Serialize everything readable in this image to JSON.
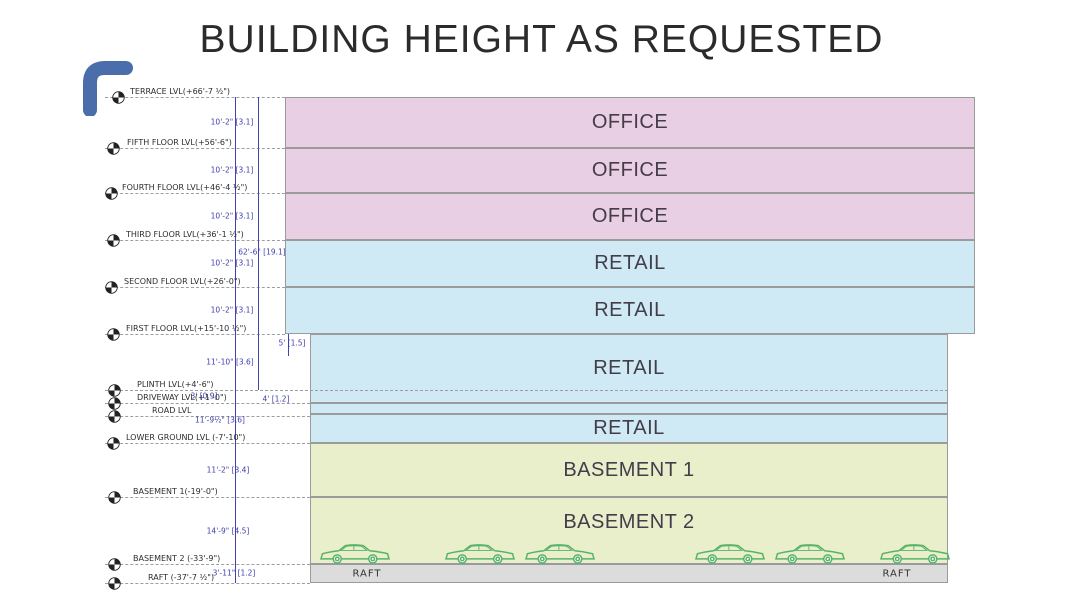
{
  "title": "BUILDING HEIGHT AS REQUESTED",
  "colors": {
    "office": "#e9cfe3",
    "retail": "#cfeaf4",
    "basement": "#e8efca",
    "raft": "#dcdcdc",
    "band_border": "#9b9b9b",
    "dimension_blue": "#4343ae",
    "corner_accent": "#4a6dab",
    "car_green": "#58b368",
    "label_dark": "#2c2c2c"
  },
  "levels": [
    {
      "label": "TERRACE LVL(+66'-7 ½\")",
      "y": 97,
      "to": 285,
      "lx": 130,
      "mx": 118
    },
    {
      "label": "FIFTH FLOOR LVL(+56'-6\")",
      "y": 148,
      "to": 285,
      "lx": 127,
      "mx": 113
    },
    {
      "label": "FOURTH FLOOR LVL(+46'-4 ½\")",
      "y": 193,
      "to": 285,
      "lx": 122,
      "mx": 111
    },
    {
      "label": "THIRD FLOOR LVL(+36'-1 ½\")",
      "y": 240,
      "to": 285,
      "lx": 126,
      "mx": 113
    },
    {
      "label": "SECOND FLOOR LVL(+26'-0\")",
      "y": 287,
      "to": 285,
      "lx": 124,
      "mx": 111
    },
    {
      "label": "FIRST FLOOR LVL(+15'-10 ½\")",
      "y": 334,
      "to": 285,
      "lx": 126,
      "mx": 113
    },
    {
      "label": "PLINTH LVL(+4'-6\")",
      "y": 390,
      "to": 948,
      "lx": 137,
      "mx": 114
    },
    {
      "label": "DRIVEWAY LVL(+1'-0\")",
      "y": 403,
      "to": 310,
      "lx": 137,
      "mx": 114
    },
    {
      "label": "ROAD LVL",
      "y": 416,
      "to": 310,
      "lx": 152,
      "mx": 114
    },
    {
      "label": "LOWER GROUND LVL (-7'-10\")",
      "y": 443,
      "to": 310,
      "lx": 126,
      "mx": 113
    },
    {
      "label": "BASEMENT 1(-19'-0\")",
      "y": 497,
      "to": 310,
      "lx": 133,
      "mx": 114
    },
    {
      "label": "BASEMENT 2 (-33'-9\")",
      "y": 564,
      "to": 310,
      "lx": 133,
      "mx": 114
    },
    {
      "label": "RAFT (-37'-7 ½\")",
      "y": 583,
      "to": 310,
      "lx": 148,
      "mx": 114
    }
  ],
  "bands": [
    {
      "label": "OFFICE",
      "kind": "office",
      "x": 285,
      "y": 97,
      "w": 690,
      "h": 51
    },
    {
      "label": "OFFICE",
      "kind": "office",
      "x": 285,
      "y": 148,
      "w": 690,
      "h": 45
    },
    {
      "label": "OFFICE",
      "kind": "office",
      "x": 285,
      "y": 193,
      "w": 690,
      "h": 47
    },
    {
      "label": "RETAIL",
      "kind": "retail",
      "x": 285,
      "y": 240,
      "w": 690,
      "h": 47
    },
    {
      "label": "RETAIL",
      "kind": "retail",
      "x": 285,
      "y": 287,
      "w": 690,
      "h": 47
    },
    {
      "label": "RETAIL",
      "kind": "retail",
      "x": 310,
      "y": 334,
      "w": 638,
      "h": 69
    },
    {
      "label": "",
      "kind": "retail",
      "x": 310,
      "y": 403,
      "w": 638,
      "h": 11
    },
    {
      "label": "RETAIL",
      "kind": "retail",
      "x": 310,
      "y": 414,
      "w": 638,
      "h": 29
    },
    {
      "label": "BASEMENT 1",
      "kind": "basement",
      "x": 310,
      "y": 443,
      "w": 638,
      "h": 54
    },
    {
      "label": "BASEMENT 2",
      "kind": "basement",
      "x": 310,
      "y": 497,
      "w": 638,
      "h": 67,
      "labelShift": -8
    },
    {
      "label": "",
      "kind": "raft",
      "x": 310,
      "y": 564,
      "w": 638,
      "h": 19
    }
  ],
  "dims": [
    {
      "text": "10'-2\" [3.1]",
      "x": 232,
      "y": 122
    },
    {
      "text": "10'-2\" [3.1]",
      "x": 232,
      "y": 170
    },
    {
      "text": "10'-2\" [3.1]",
      "x": 232,
      "y": 216
    },
    {
      "text": "62'-6\" [19.1]",
      "x": 262,
      "y": 252
    },
    {
      "text": "10'-2\" [3.1]",
      "x": 232,
      "y": 263
    },
    {
      "text": "10'-2\" [3.1]",
      "x": 232,
      "y": 310
    },
    {
      "text": "5' [1.5]",
      "x": 292,
      "y": 343
    },
    {
      "text": "11'-10\" [3.6]",
      "x": 230,
      "y": 362
    },
    {
      "text": "3' [0.9]",
      "x": 204,
      "y": 396
    },
    {
      "text": "4' [1.2]",
      "x": 276,
      "y": 399
    },
    {
      "text": "11'-9½\" [3.6]",
      "x": 220,
      "y": 420
    },
    {
      "text": "11'-2\" [3.4]",
      "x": 228,
      "y": 470
    },
    {
      "text": "14'-9\" [4.5]",
      "x": 228,
      "y": 531
    },
    {
      "text": "3'-11\" [1.2]",
      "x": 234,
      "y": 573
    }
  ],
  "dim_lines": [
    {
      "x": 235,
      "y1": 97,
      "y2": 583
    },
    {
      "x": 258,
      "y1": 97,
      "y2": 390
    },
    {
      "x": 288,
      "y1": 334,
      "y2": 356
    }
  ],
  "cars": {
    "y": 541,
    "w": 74,
    "h": 24,
    "positions": [
      318,
      443,
      523,
      693,
      773,
      878
    ]
  },
  "raft": {
    "labels": [
      {
        "text": "RAFT",
        "x": 367,
        "y": 574
      },
      {
        "text": "RAFT",
        "x": 897,
        "y": 574
      }
    ]
  }
}
